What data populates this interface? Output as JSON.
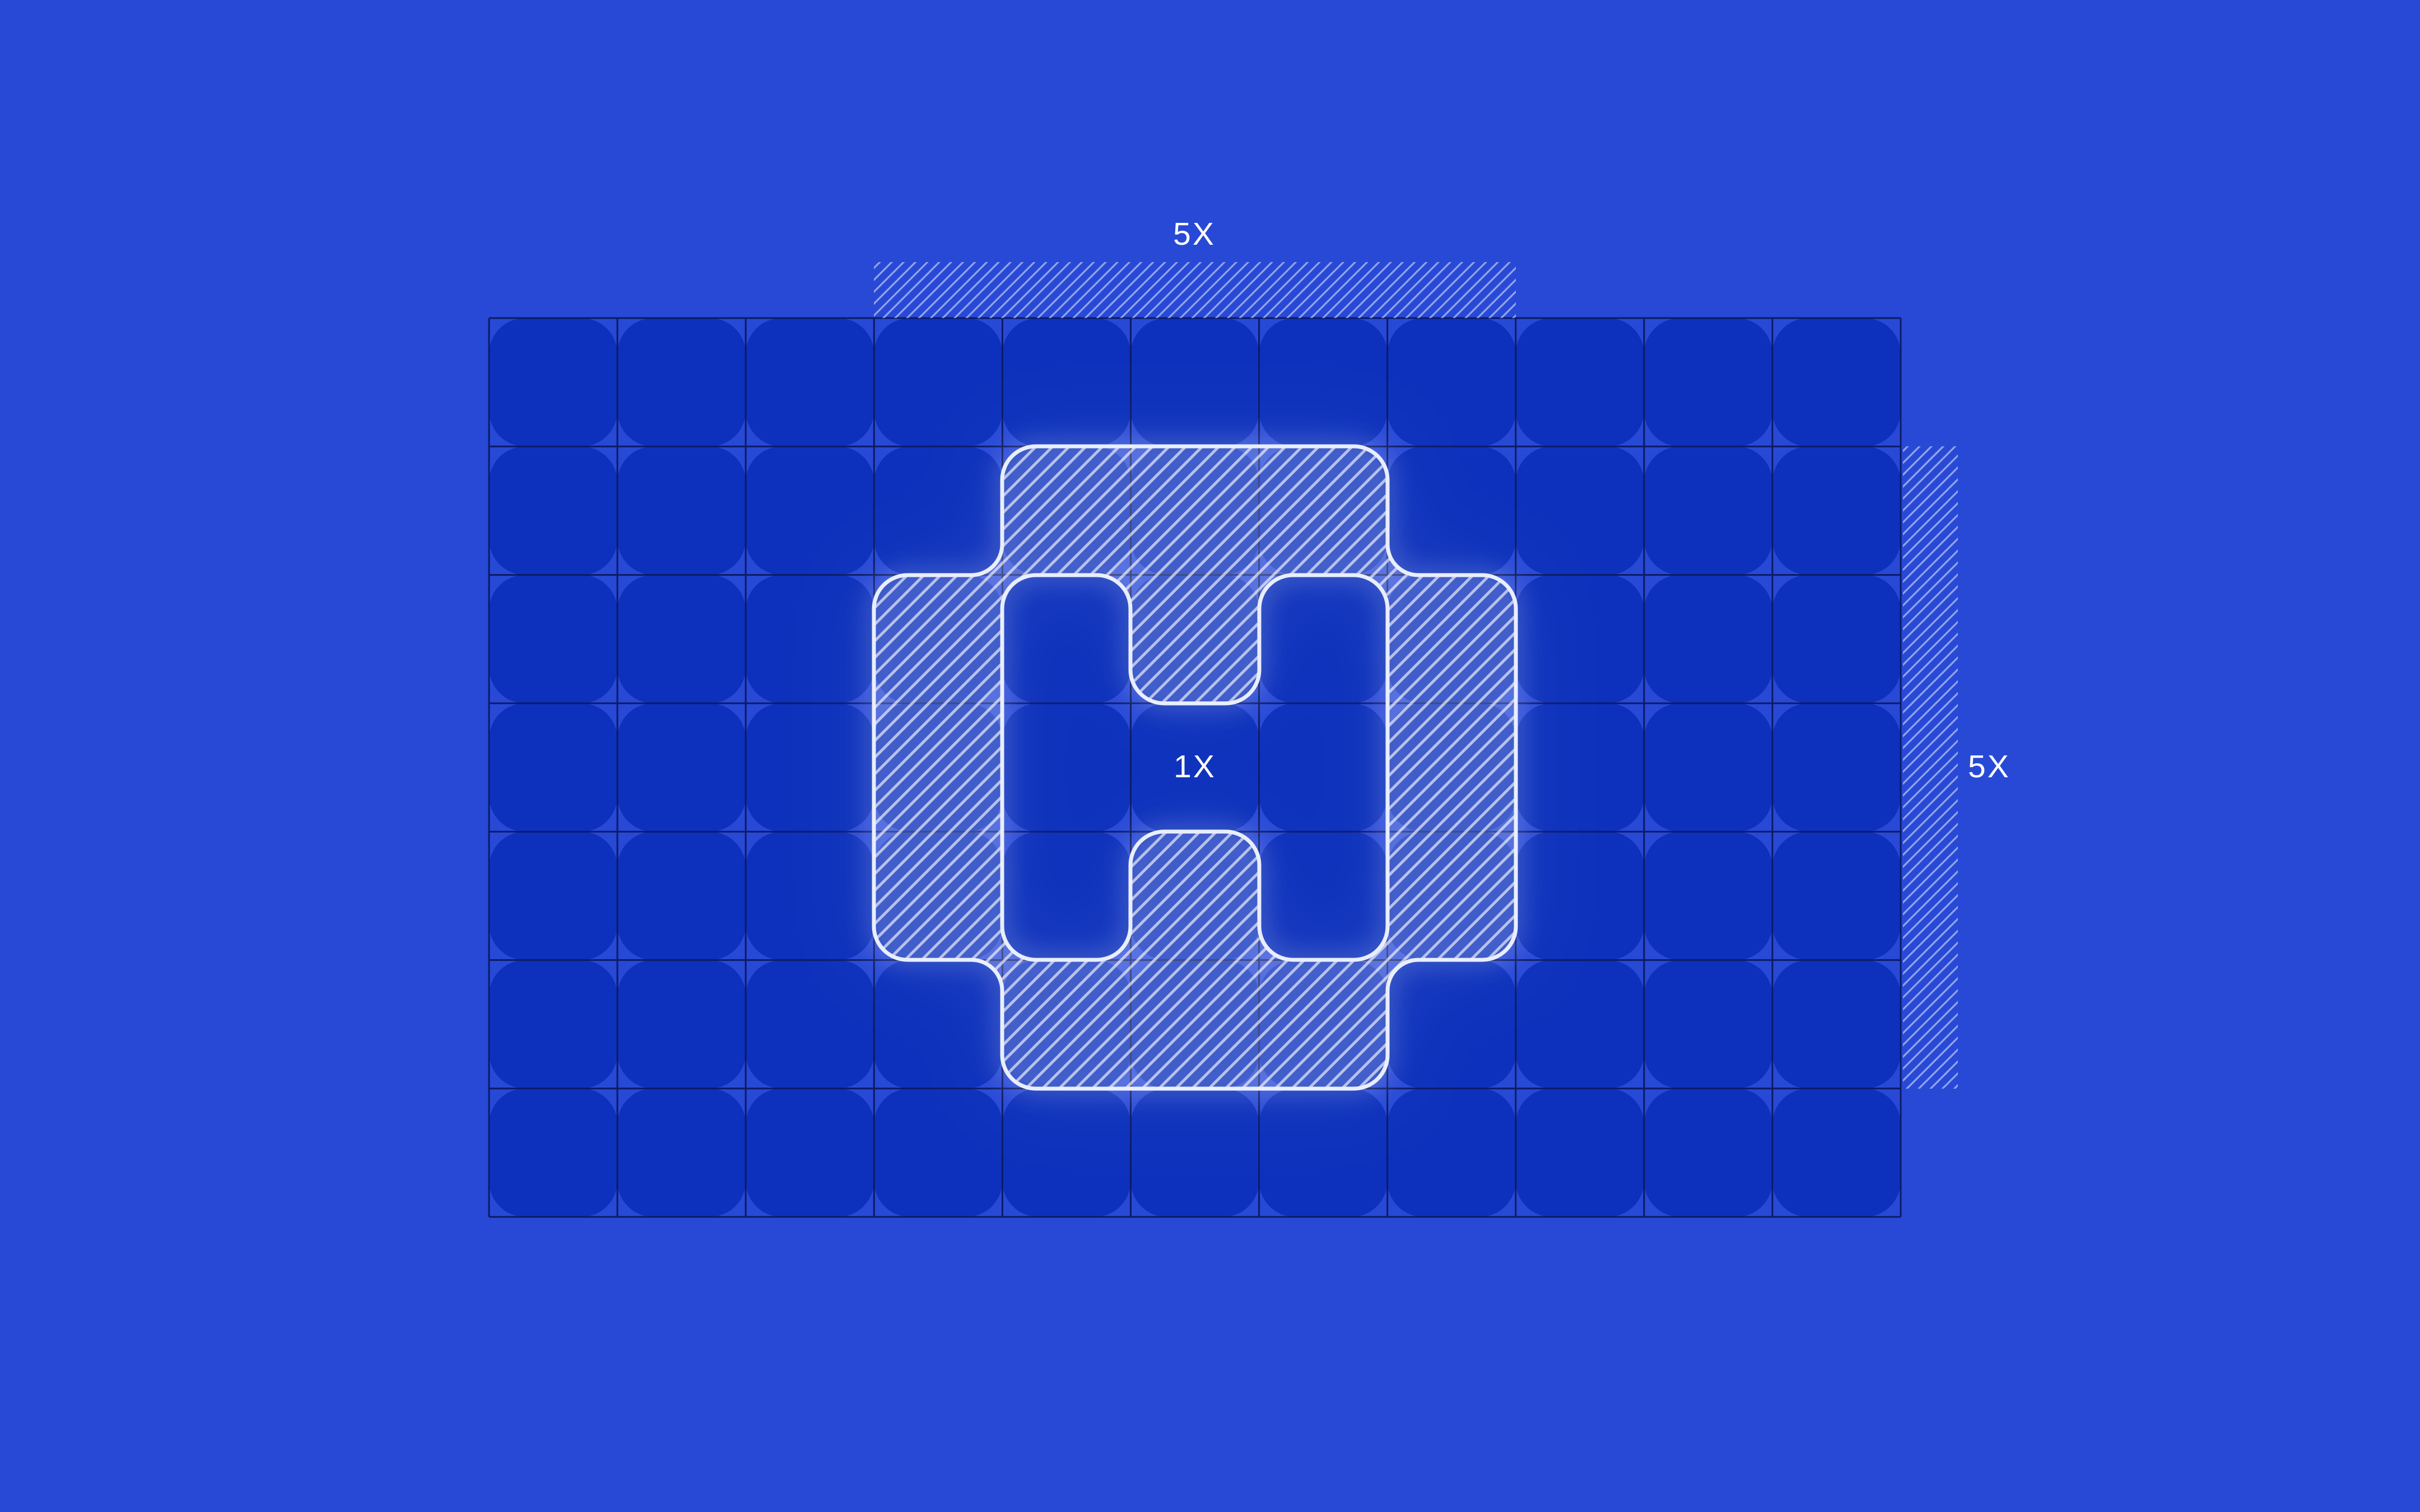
{
  "figure": {
    "type": "logo-clearspace-construction-diagram",
    "labels": {
      "top": "5X",
      "right": "5X",
      "center": "1X"
    },
    "grid": {
      "columns": 11,
      "rows": 7
    },
    "logo_block": {
      "columns": 5,
      "rows": 5
    },
    "colors": {
      "background": "#2849D6",
      "cell": "#0D31BC",
      "grid_line": "#0B1B64",
      "hatch_line": "#FFFFFF",
      "shape_outline": "#E9EEFC",
      "label_text": "#FFFFFF"
    }
  }
}
